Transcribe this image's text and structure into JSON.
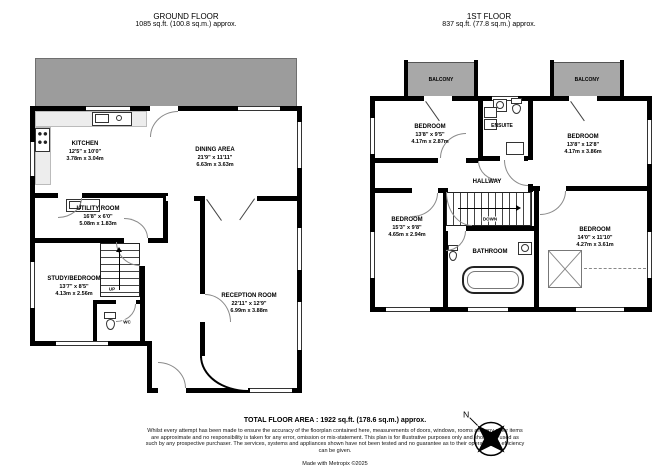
{
  "ground_floor": {
    "title": "GROUND FLOOR",
    "area": "1085 sq.ft. (100.8 sq.m.) approx.",
    "rooms": {
      "kitchen": {
        "name": "KITCHEN",
        "imperial": "12'5\" x 10'0\"",
        "metric": "3.78m x 3.04m"
      },
      "dining": {
        "name": "DINING AREA",
        "imperial": "21'9\" x 11'11\"",
        "metric": "6.63m x 3.63m"
      },
      "utility": {
        "name": "UTILITY ROOM",
        "imperial": "16'8\" x 6'0\"",
        "metric": "5.08m x 1.83m"
      },
      "study": {
        "name": "STUDY/BEDROOM",
        "imperial": "13'7\" x 8'5\"",
        "metric": "4.13m x 2.56m"
      },
      "reception": {
        "name": "RECEPTION ROOM",
        "imperial": "22'11\" x 12'9\"",
        "metric": "6.99m x 3.88m"
      },
      "wc": {
        "name": "WC"
      }
    },
    "stairs_label": "UP"
  },
  "first_floor": {
    "title": "1ST FLOOR",
    "area": "837 sq.ft. (77.8 sq.m.) approx.",
    "rooms": {
      "bedroom_front_left": {
        "name": "BEDROOM",
        "imperial": "13'8\" x 9'5\"",
        "metric": "4.17m x 2.87m"
      },
      "bedroom_front_right": {
        "name": "BEDROOM",
        "imperial": "13'8\" x 12'8\"",
        "metric": "4.17m x 3.86m"
      },
      "bedroom_back_left": {
        "name": "BEDROOM",
        "imperial": "15'3\" x 9'8\"",
        "metric": "4.65m x 2.94m"
      },
      "bedroom_back_right": {
        "name": "BEDROOM",
        "imperial": "14'0\" x 11'10\"",
        "metric": "4.27m x 3.61m"
      },
      "hallway": {
        "name": "HALLWAY"
      },
      "ensuite": {
        "name": "ENSUITE"
      },
      "bathroom": {
        "name": "BATHROOM"
      },
      "balcony_left": {
        "name": "BALCONY"
      },
      "balcony_right": {
        "name": "BALCONY"
      }
    },
    "stairs_label": "DOWN"
  },
  "footer": {
    "total_area": "TOTAL FLOOR AREA : 1922 sq.ft. (178.6 sq.m.) approx.",
    "disclaimer": "Whilst every attempt has been made to ensure the accuracy of the floorplan contained here, measurements of doors, windows, rooms and any other items are approximate and no responsibility is taken for any error, omission or mis-statement. This plan is for illustrative purposes only and should be used as such by any prospective purchaser. The services, systems and appliances shown have not been tested and no guarantee as to their operability or efficiency can be given.",
    "credit": "Made with Metropix ©2025"
  },
  "compass": {
    "north_label": "N"
  },
  "colors": {
    "wall": "#000000",
    "terrace_fill": "#9c9c9c",
    "balcony_fill": "#a8a8a8",
    "counter_fill": "#ededed"
  }
}
